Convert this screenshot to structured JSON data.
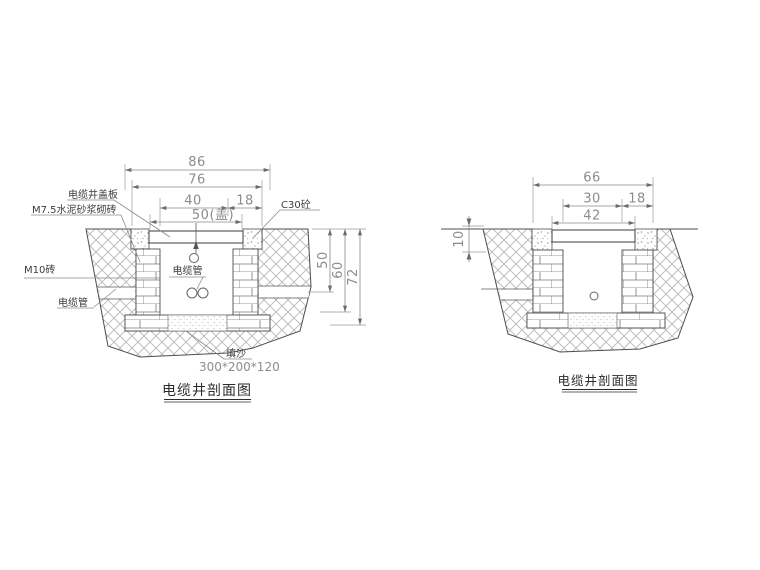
{
  "figures": {
    "left": {
      "title": "电缆井剖面图",
      "dims": {
        "overall": "86",
        "opening": "76",
        "inner": "40",
        "collar": "18",
        "cover": "50(盖)",
        "depth_inner": "50",
        "depth_wall": "60",
        "depth_total": "72"
      },
      "labels": {
        "cover_plate": "电缆井盖板",
        "mortar_brick": "M7.5水泥砂浆砌砖",
        "m10_brick": "M10砖",
        "cable_duct_side": "电缆管",
        "c30_concrete": "C30砼",
        "cable_duct_center": "电缆管",
        "fill_sand": "填沙",
        "sand_size": "300*200*120"
      }
    },
    "right": {
      "title": "电缆井剖面图",
      "dims": {
        "overall": "66",
        "inner": "30",
        "collar": "18",
        "cover": "42",
        "mortar_depth": "10"
      }
    }
  },
  "colors": {
    "line": "#4d4d4d",
    "dimension": "#8c8c8c",
    "text": "#3c3c3c"
  }
}
